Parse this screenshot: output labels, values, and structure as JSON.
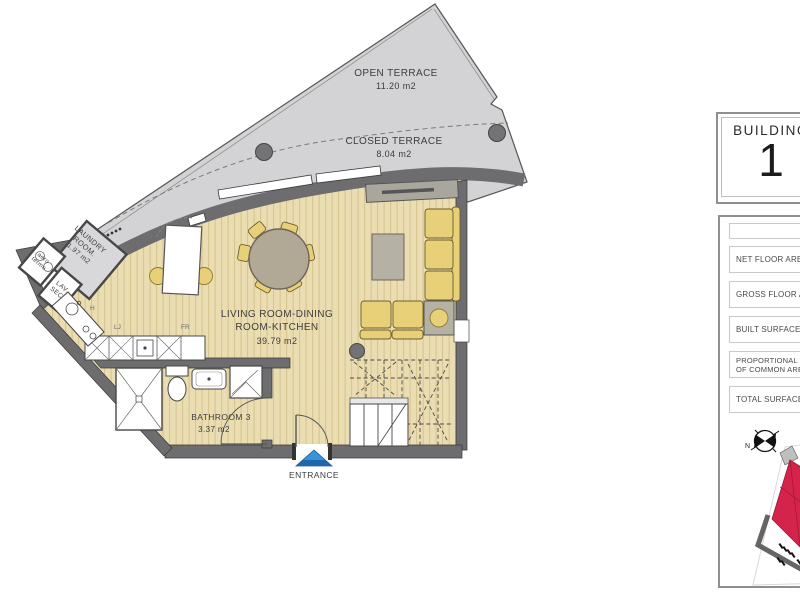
{
  "plan": {
    "rooms": {
      "open_terrace": {
        "name": "OPEN TERRACE",
        "area": "11.20 m2"
      },
      "closed_terrace": {
        "name": "CLOSED TERRACE",
        "area": "8.04 m2"
      },
      "living": {
        "line1": "LIVING ROOM-DINING",
        "line2": "ROOM-KITCHEN",
        "area": "39.79 m2"
      },
      "bathroom": {
        "name": "BATHROOM 3",
        "area": "3.37 m2"
      },
      "laundry": {
        "line1": "LAUNDRY",
        "line2": "ROOM.",
        "area": "1.97 m2"
      },
      "aero_termo": {
        "line1": "aero",
        "line2": "termo"
      },
      "lav_sec": {
        "line1": "LAV.",
        "line2": "SEC."
      }
    },
    "kitchen_labels": {
      "h": "H",
      "lj": "LJ",
      "fr": "FR"
    },
    "entrance_label": "ENTRANCE",
    "compass_north": "N"
  },
  "sidebar": {
    "building_label": "BUILDING",
    "building_number": "1",
    "rows": [
      {
        "label": ""
      },
      {
        "label": "NET FLOOR AREA"
      },
      {
        "label": "GROSS FLOOR AREA"
      },
      {
        "label": "BUILT SURFACE OF T"
      },
      {
        "label": "PROPORTIONAL PAR",
        "label2": "OF COMMON AREA"
      },
      {
        "label": "TOTAL SURFACE AR"
      }
    ]
  },
  "colors": {
    "floor_beige": "#ebddb2",
    "floor_stripe": "#d6c38e",
    "terrace_gray": "#d3d3d5",
    "wall_gray": "#6d6d6f",
    "furniture_yellow": "#e7d077",
    "table_gray": "#b1a895",
    "accent_red": "#d5244c",
    "entrance_blue": "#2f86c4"
  }
}
